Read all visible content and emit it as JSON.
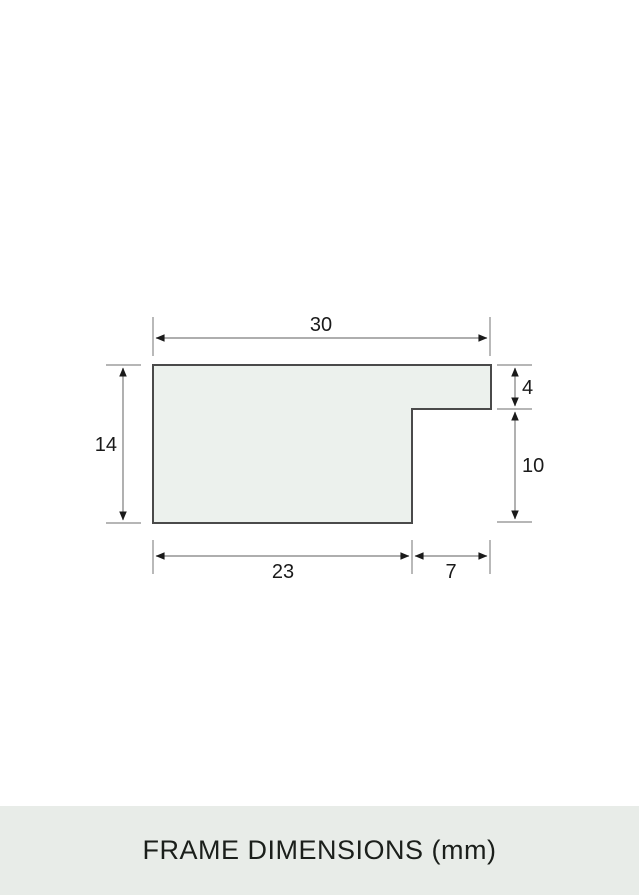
{
  "page": {
    "background_color": "#ffffff"
  },
  "diagram": {
    "description": "frame-moulding-cross-section-profile",
    "unit": "mm",
    "shape": {
      "fill_color": "#ecf1ed",
      "stroke_color": "#4a4a4a"
    },
    "line_color": "#7d7d7d",
    "arrow_color": "#1a1a1a",
    "text_color": "#1a1a1a",
    "dimensions": {
      "overall_width": {
        "value": "30"
      },
      "overall_height": {
        "value": "14"
      },
      "lip_height": {
        "value": "4"
      },
      "rabbet_height": {
        "value": "10"
      },
      "base_width": {
        "value": "23"
      },
      "rabbet_width": {
        "value": "7"
      }
    }
  },
  "footer": {
    "label": "FRAME DIMENSIONS (mm)",
    "background_color": "#e8ece8",
    "text_color": "#1b1f1b"
  }
}
